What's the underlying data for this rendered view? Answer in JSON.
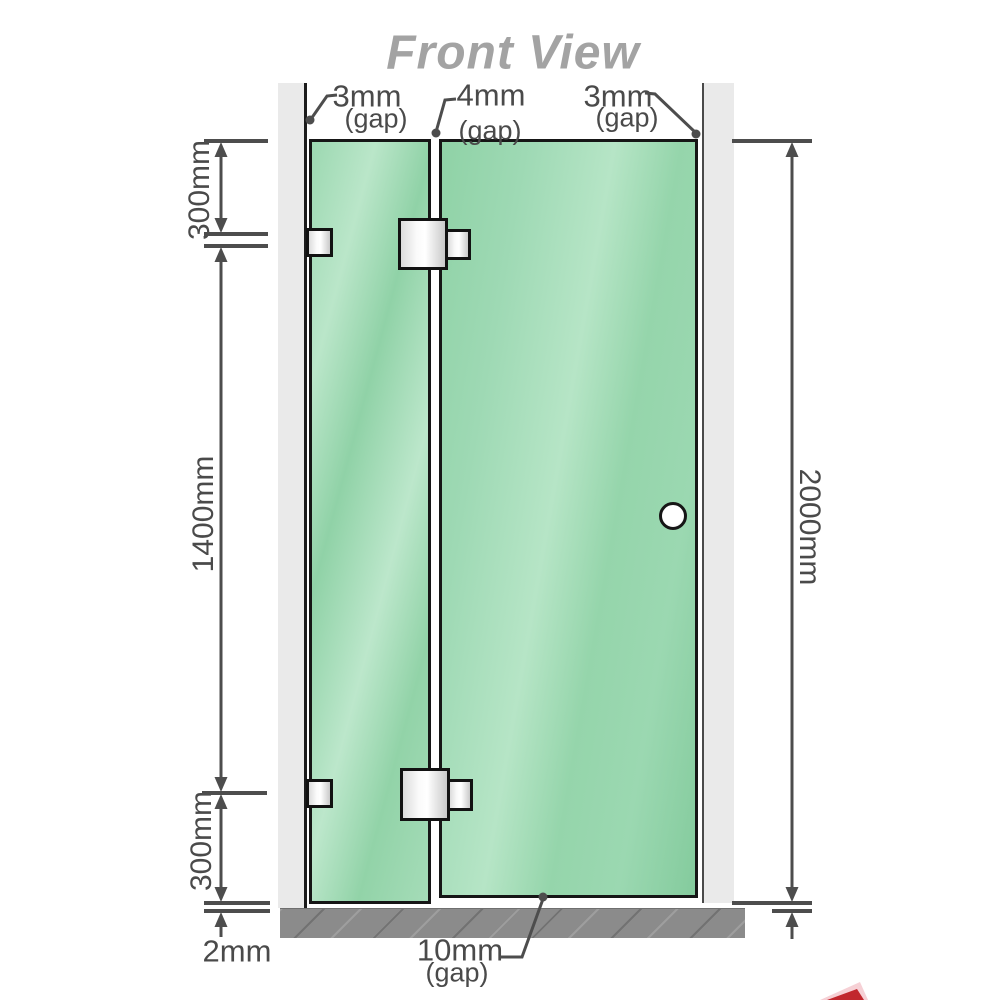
{
  "title": "Front View",
  "dimensions": {
    "top_left_gap": {
      "value": "3mm",
      "suffix": "(gap)"
    },
    "middle_gap": {
      "value": "4mm",
      "suffix": "(gap)"
    },
    "top_right_gap": {
      "value": "3mm",
      "suffix": "(gap)"
    },
    "upper_section": "300mm",
    "middle_section": "1400mm",
    "lower_section": "300mm",
    "overall_height": "2000mm",
    "floor_clearance": "2mm",
    "door_floor_gap": {
      "value": "10mm",
      "suffix": "(gap)"
    }
  },
  "components": {
    "left_wall": "wall channel",
    "right_wall": "wall channel",
    "fixed_panel": "fixed glass panel",
    "door_panel": "glass door panel",
    "hinge_top": "glass-to-glass hinge",
    "hinge_bottom": "glass-to-glass hinge",
    "bracket_top": "wall bracket",
    "bracket_bottom": "wall bracket",
    "handle": "round door knob",
    "floor": "floor / base"
  },
  "colors": {
    "glass": "#96d5ac",
    "glass_highlight": "#bce7cb",
    "wall": "#eaeaea",
    "floor": "#8b8b8b",
    "outline": "#161616",
    "dimension_lines": "#4d4d4d",
    "title_text": "#a3a3a3",
    "corner_mark_red": "#c1272d"
  }
}
